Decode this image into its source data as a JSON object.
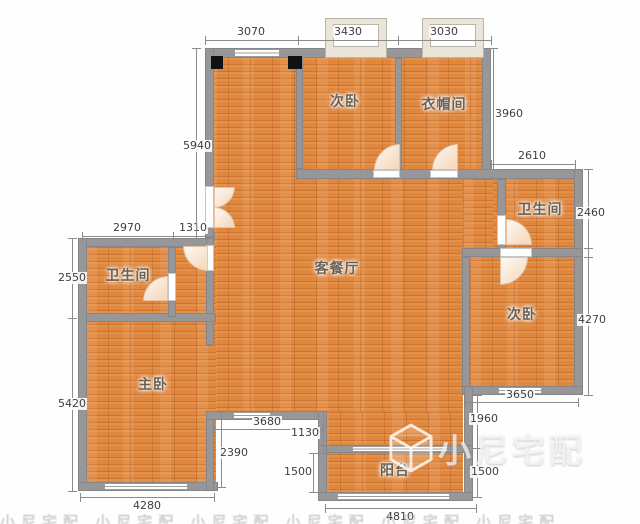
{
  "watermark": {
    "text": "小尼宅配",
    "bottom_band_repeat": 6
  },
  "rooms": [
    {
      "name": "bedroom-second-top",
      "label": "次卧",
      "x": 345,
      "y": 101
    },
    {
      "name": "cloakroom",
      "label": "衣帽间",
      "x": 444,
      "y": 104
    },
    {
      "name": "bathroom-right",
      "label": "卫生间",
      "x": 540,
      "y": 209
    },
    {
      "name": "bedroom-second-right",
      "label": "次卧",
      "x": 522,
      "y": 314
    },
    {
      "name": "living-dining-room",
      "label": "客餐厅",
      "x": 337,
      "y": 268
    },
    {
      "name": "bathroom-left",
      "label": "卫生间",
      "x": 128,
      "y": 275
    },
    {
      "name": "master-bedroom",
      "label": "主卧",
      "x": 153,
      "y": 384
    },
    {
      "name": "balcony",
      "label": "阳台",
      "x": 395,
      "y": 470
    }
  ],
  "dimensions": [
    {
      "value": "3070",
      "dir": "h",
      "x": 205,
      "y": 40,
      "len": 93,
      "lx": 251,
      "ly": 32
    },
    {
      "value": "3430",
      "dir": "h",
      "x": 298,
      "y": 40,
      "len": 100,
      "lx": 348,
      "ly": 32
    },
    {
      "value": "3030",
      "dir": "h",
      "x": 398,
      "y": 40,
      "len": 93,
      "lx": 444,
      "ly": 32
    },
    {
      "value": "2970",
      "dir": "h",
      "x": 82,
      "y": 236,
      "len": 91,
      "lx": 127,
      "ly": 228
    },
    {
      "value": "1310",
      "dir": "h",
      "x": 173,
      "y": 236,
      "len": 41,
      "lx": 193,
      "ly": 228
    },
    {
      "value": "2610",
      "dir": "h",
      "x": 491,
      "y": 164,
      "len": 84,
      "lx": 532,
      "ly": 156
    },
    {
      "value": "3650",
      "dir": "h",
      "x": 465,
      "y": 402,
      "len": 113,
      "lx": 520,
      "ly": 395
    },
    {
      "value": "3680",
      "dir": "h",
      "x": 214,
      "y": 429,
      "len": 108,
      "lx": 267,
      "ly": 422
    },
    {
      "value": "4280",
      "dir": "h",
      "x": 80,
      "y": 497,
      "len": 134,
      "lx": 147,
      "ly": 506
    },
    {
      "value": "4810",
      "dir": "h",
      "x": 325,
      "y": 508,
      "len": 151,
      "lx": 400,
      "ly": 517
    },
    {
      "value": "5940",
      "dir": "v",
      "x": 196,
      "y": 48,
      "len": 190,
      "lx": 197,
      "ly": 146
    },
    {
      "value": "3960",
      "dir": "v",
      "x": 493,
      "y": 48,
      "len": 121,
      "lx": 509,
      "ly": 114
    },
    {
      "value": "2460",
      "dir": "v",
      "x": 588,
      "y": 169,
      "len": 88,
      "lx": 591,
      "ly": 213
    },
    {
      "value": "4270",
      "dir": "v",
      "x": 588,
      "y": 248,
      "len": 147,
      "lx": 592,
      "ly": 320
    },
    {
      "value": "2550",
      "dir": "v",
      "x": 72,
      "y": 238,
      "len": 80,
      "lx": 72,
      "ly": 278
    },
    {
      "value": "5420",
      "dir": "v",
      "x": 72,
      "y": 318,
      "len": 173,
      "lx": 72,
      "ly": 404
    },
    {
      "value": "1960",
      "dir": "v",
      "x": 477,
      "y": 395,
      "len": 53,
      "lx": 484,
      "ly": 419
    },
    {
      "value": "1500",
      "dir": "v",
      "x": 477,
      "y": 448,
      "len": 49,
      "lx": 485,
      "ly": 472
    },
    {
      "value": "1500",
      "dir": "v",
      "x": 313,
      "y": 453,
      "len": 39,
      "lx": 298,
      "ly": 472
    },
    {
      "value": "1130",
      "dir": "v",
      "x": 323,
      "y": 411,
      "len": 42,
      "lx": 305,
      "ly": 433
    },
    {
      "value": "2390",
      "dir": "v",
      "x": 221,
      "y": 412,
      "len": 75,
      "lx": 234,
      "ly": 453
    }
  ]
}
